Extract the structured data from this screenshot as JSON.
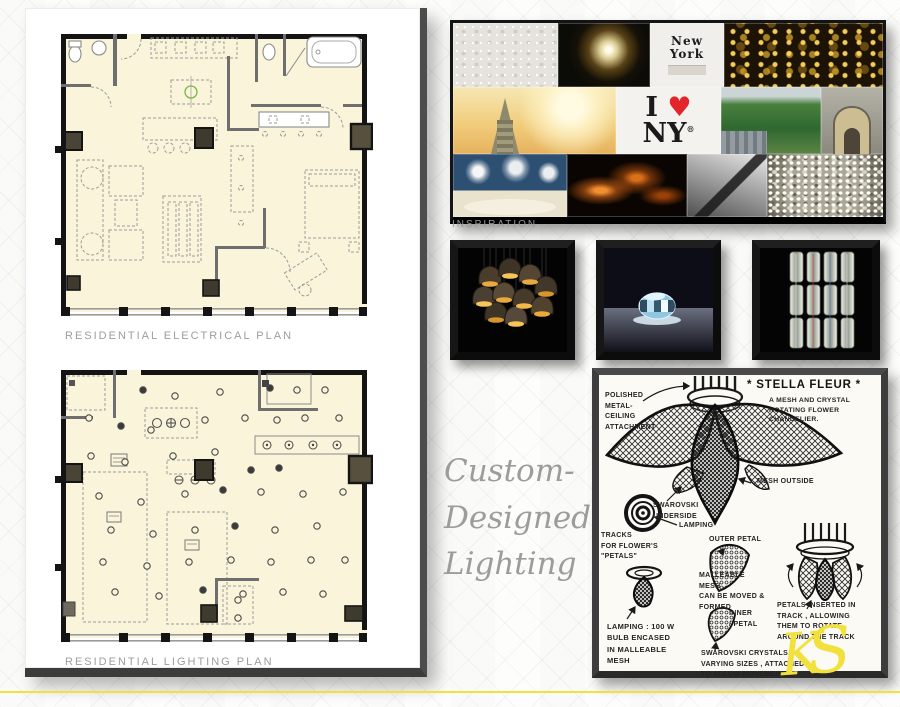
{
  "plans": {
    "electrical_title": "RESIDENTIAL ELECTRICAL PLAN",
    "lighting_title": "RESIDENTIAL LIGHTING PLAN"
  },
  "inspiration": {
    "label": "INSPIRATION",
    "ny_logo": {
      "i": "I",
      "heart": "♥",
      "ny": "NY",
      "reg": "®"
    },
    "type_tile": {
      "line1": "New",
      "line2": "York"
    }
  },
  "headline": {
    "line1": "Custom-",
    "line2": "Designed",
    "line3": "Lighting"
  },
  "sketch": {
    "title": "* STELLA FLEUR *",
    "subtitle": "A MESH AND CRYSTAL\nROTATING FLOWER\nCHANDELIER.",
    "annotations": {
      "polished": "POLISHED\nMETAL-\nCEILING\nATTACHMENT",
      "swarovski_underside": "SWAROVSKI\nUNDERSIDE",
      "mesh_outside": "MESH  OUTSIDE",
      "lamping": "LAMPING",
      "tracks": "TRACKS\nFOR FLOWER'S\n\"PETALS\"",
      "outer_petal": "OUTER PETAL",
      "malleable": "MALLEABLE\nMESH ,\nCAN BE MOVED & FORMED",
      "inner_petal": "INNER\n/ PETAL",
      "lamping_bulb": "LAMPING : 100 W\nBULB ENCASED\nIN MALLEABLE\nMESH",
      "swarovski_crystals": "SWAROVSKI CRYSTALS ,\nVARYING SIZES , ATTACHED\nTO ALLOW MOVEMENT",
      "petals_track": "PETALS INSERTED IN\nTRACK , ALLOWING\nTHEM TO ROTATE\nAROUND THE TRACK"
    }
  },
  "signature": {
    "monogram_k": "K",
    "monogram_s": "S"
  },
  "colors": {
    "accent_yellow": "#f2e13c",
    "heart_red": "#e3242b",
    "plan_fill": "#faf5da",
    "wall_black": "#141414"
  }
}
